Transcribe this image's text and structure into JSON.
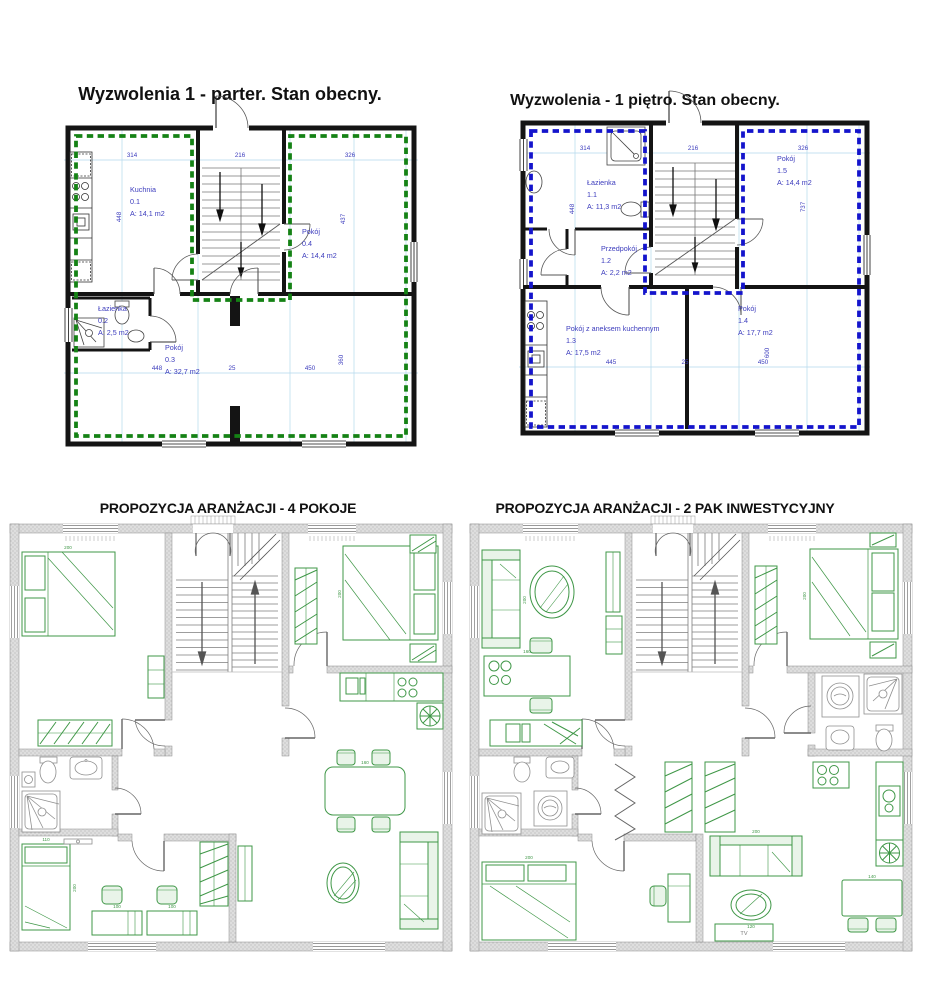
{
  "p1": {
    "title": "Wyzwolenia 1 - parter. Stan obecny.",
    "kuchnia_name": "Kuchnia",
    "kuchnia_no": "0.1",
    "kuchnia_area": "A: 14,1 m2",
    "lazienka_name": "Łazienka",
    "lazienka_no": "0.2",
    "lazienka_area": "A: 2,5 m2",
    "pokoj03_name": "Pokój",
    "pokoj03_no": "0.3",
    "pokoj03_area": "A: 32,7 m2",
    "pokoj04_name": "Pokój",
    "pokoj04_no": "0.4",
    "pokoj04_area": "A: 14,4 m2",
    "dim_top1": "314",
    "dim_top2": "216",
    "dim_top3": "326",
    "dim_bottom1": "448",
    "dim_bottom2": "25",
    "dim_bottom3": "450",
    "dim_left": "448",
    "dim_right1": "437",
    "dim_right2": "360"
  },
  "p2": {
    "title": "Wyzwolenia - 1 piętro. Stan obecny.",
    "lazienka_name": "Łazienka",
    "lazienka_no": "1.1",
    "lazienka_area": "A: 11,3 m2",
    "przedpokoj_name": "Przedpokój",
    "przedpokoj_no": "1.2",
    "przedpokoj_area": "A: 2,2 m2",
    "pokoj13_name": "Pokój z aneksem kuchennym",
    "pokoj13_no": "1.3",
    "pokoj13_area": "A: 17,5 m2",
    "pokoj14_name": "Pokój",
    "pokoj14_no": "1.4",
    "pokoj14_area": "A: 17,7 m2",
    "pokoj15_name": "Pokój",
    "pokoj15_no": "1.5",
    "pokoj15_area": "A: 14,4 m2",
    "dim_top1": "314",
    "dim_top2": "216",
    "dim_top3": "326",
    "dim_bottom1": "445",
    "dim_bottom2": "25",
    "dim_bottom3": "450",
    "dim_left": "448",
    "dim_right1": "737",
    "dim_right2": "600"
  },
  "p3": {
    "title": "PROPOZYCJA ARANŻACJI - 4 POKOJE",
    "dims": {
      "bed_left": "200",
      "bed_right": "200",
      "single_bed_w": "110",
      "single_bed_l": "200",
      "desk_left": "100",
      "desk_right": "100",
      "dining_table": "160"
    }
  },
  "p4": {
    "title": "PROPOZYCJA ARANŻACJI - 2 PAK INWESTYCYJNY",
    "tv": "TV",
    "dims": {
      "sofa_left": "200",
      "bed": "200",
      "bed_bottom": "200",
      "sofa_right": "200",
      "coffee_table": "120",
      "dining_table": "140",
      "kitchen_table": "160"
    }
  },
  "colors": {
    "parter_outline": "#158215",
    "pietro_outline": "#1414cc",
    "label_blue": "#3c3cbd",
    "furniture_green": "#3f9747"
  }
}
